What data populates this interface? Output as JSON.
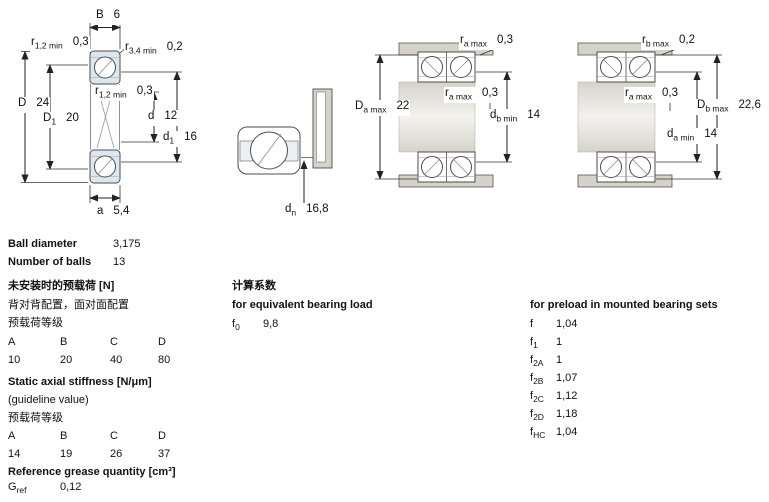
{
  "specs": {
    "ball_diameter": {
      "label": "Ball diameter",
      "value": "3,175"
    },
    "number_of_balls": {
      "label": "Number of balls",
      "value": "13"
    },
    "preload_unmounted": {
      "title": "未安装时的预载荷 [N]",
      "subtitle": "背对背配置，面对面配置",
      "grade_label": "预载荷等级",
      "grades": [
        "A",
        "B",
        "C",
        "D"
      ],
      "values": [
        "10",
        "20",
        "40",
        "80"
      ]
    },
    "stiffness": {
      "title": "Static axial stiffness [N/μm]",
      "note": "(guideline value)",
      "grade_label": "预载荷等级",
      "grades": [
        "A",
        "B",
        "C",
        "D"
      ],
      "values": [
        "14",
        "19",
        "26",
        "37"
      ]
    },
    "grease": {
      "title": "Reference grease quantity [cm³]",
      "symbol": "G",
      "symbol_sub": "ref",
      "value": "0,12"
    }
  },
  "factors": {
    "title_cn": "计算系数",
    "equivalent": {
      "title": "for equivalent bearing load",
      "symbol": "f",
      "symbol_sub": "0",
      "value": "9,8"
    },
    "preload_sets": {
      "title": "for preload in mounted bearing sets",
      "rows": [
        {
          "symbol": "f",
          "sub": "",
          "value": "1,04"
        },
        {
          "symbol": "f",
          "sub": "1",
          "value": "1"
        },
        {
          "symbol": "f",
          "sub": "2A",
          "value": "1"
        },
        {
          "symbol": "f",
          "sub": "2B",
          "value": "1,07"
        },
        {
          "symbol": "f",
          "sub": "2C",
          "value": "1,12"
        },
        {
          "symbol": "f",
          "sub": "2D",
          "value": "1,18"
        },
        {
          "symbol": "f",
          "sub": "HC",
          "value": "1,04"
        }
      ]
    }
  },
  "drawings": {
    "cross_section": {
      "B": {
        "base": "B",
        "sub": "",
        "value": "6"
      },
      "r12_top": {
        "base": "r",
        "sub": "1,2 min",
        "value": "0,3"
      },
      "r34_top": {
        "base": "r",
        "sub": "3,4 min",
        "value": "0,2"
      },
      "D": {
        "base": "D",
        "sub": "",
        "value": "24"
      },
      "D1": {
        "base": "D",
        "sub": "1",
        "value": "20"
      },
      "r12_mid": {
        "base": "r",
        "sub": "1,2 min",
        "value": "0,3"
      },
      "d": {
        "base": "d",
        "sub": "",
        "value": "12"
      },
      "d1": {
        "base": "d",
        "sub": "1",
        "value": "16"
      },
      "a": {
        "base": "a",
        "sub": "",
        "value": "5,4"
      }
    },
    "front_view": {
      "dn": {
        "base": "d",
        "sub": "n",
        "value": "16,8"
      }
    },
    "mounted_set_a": {
      "ra_top": {
        "base": "r",
        "sub": "a max",
        "value": "0,3"
      },
      "ra_mid": {
        "base": "r",
        "sub": "a max",
        "value": "0,3"
      },
      "Da": {
        "base": "D",
        "sub": "a max",
        "value": "22"
      },
      "db": {
        "base": "d",
        "sub": "b min",
        "value": "14"
      }
    },
    "mounted_set_b": {
      "rb_top": {
        "base": "r",
        "sub": "b max",
        "value": "0,2"
      },
      "ra_mid": {
        "base": "r",
        "sub": "a max",
        "value": "0,3"
      },
      "Db": {
        "base": "D",
        "sub": "b max",
        "value": "22,6"
      },
      "da": {
        "base": "d",
        "sub": "a min",
        "value": "14"
      }
    }
  }
}
